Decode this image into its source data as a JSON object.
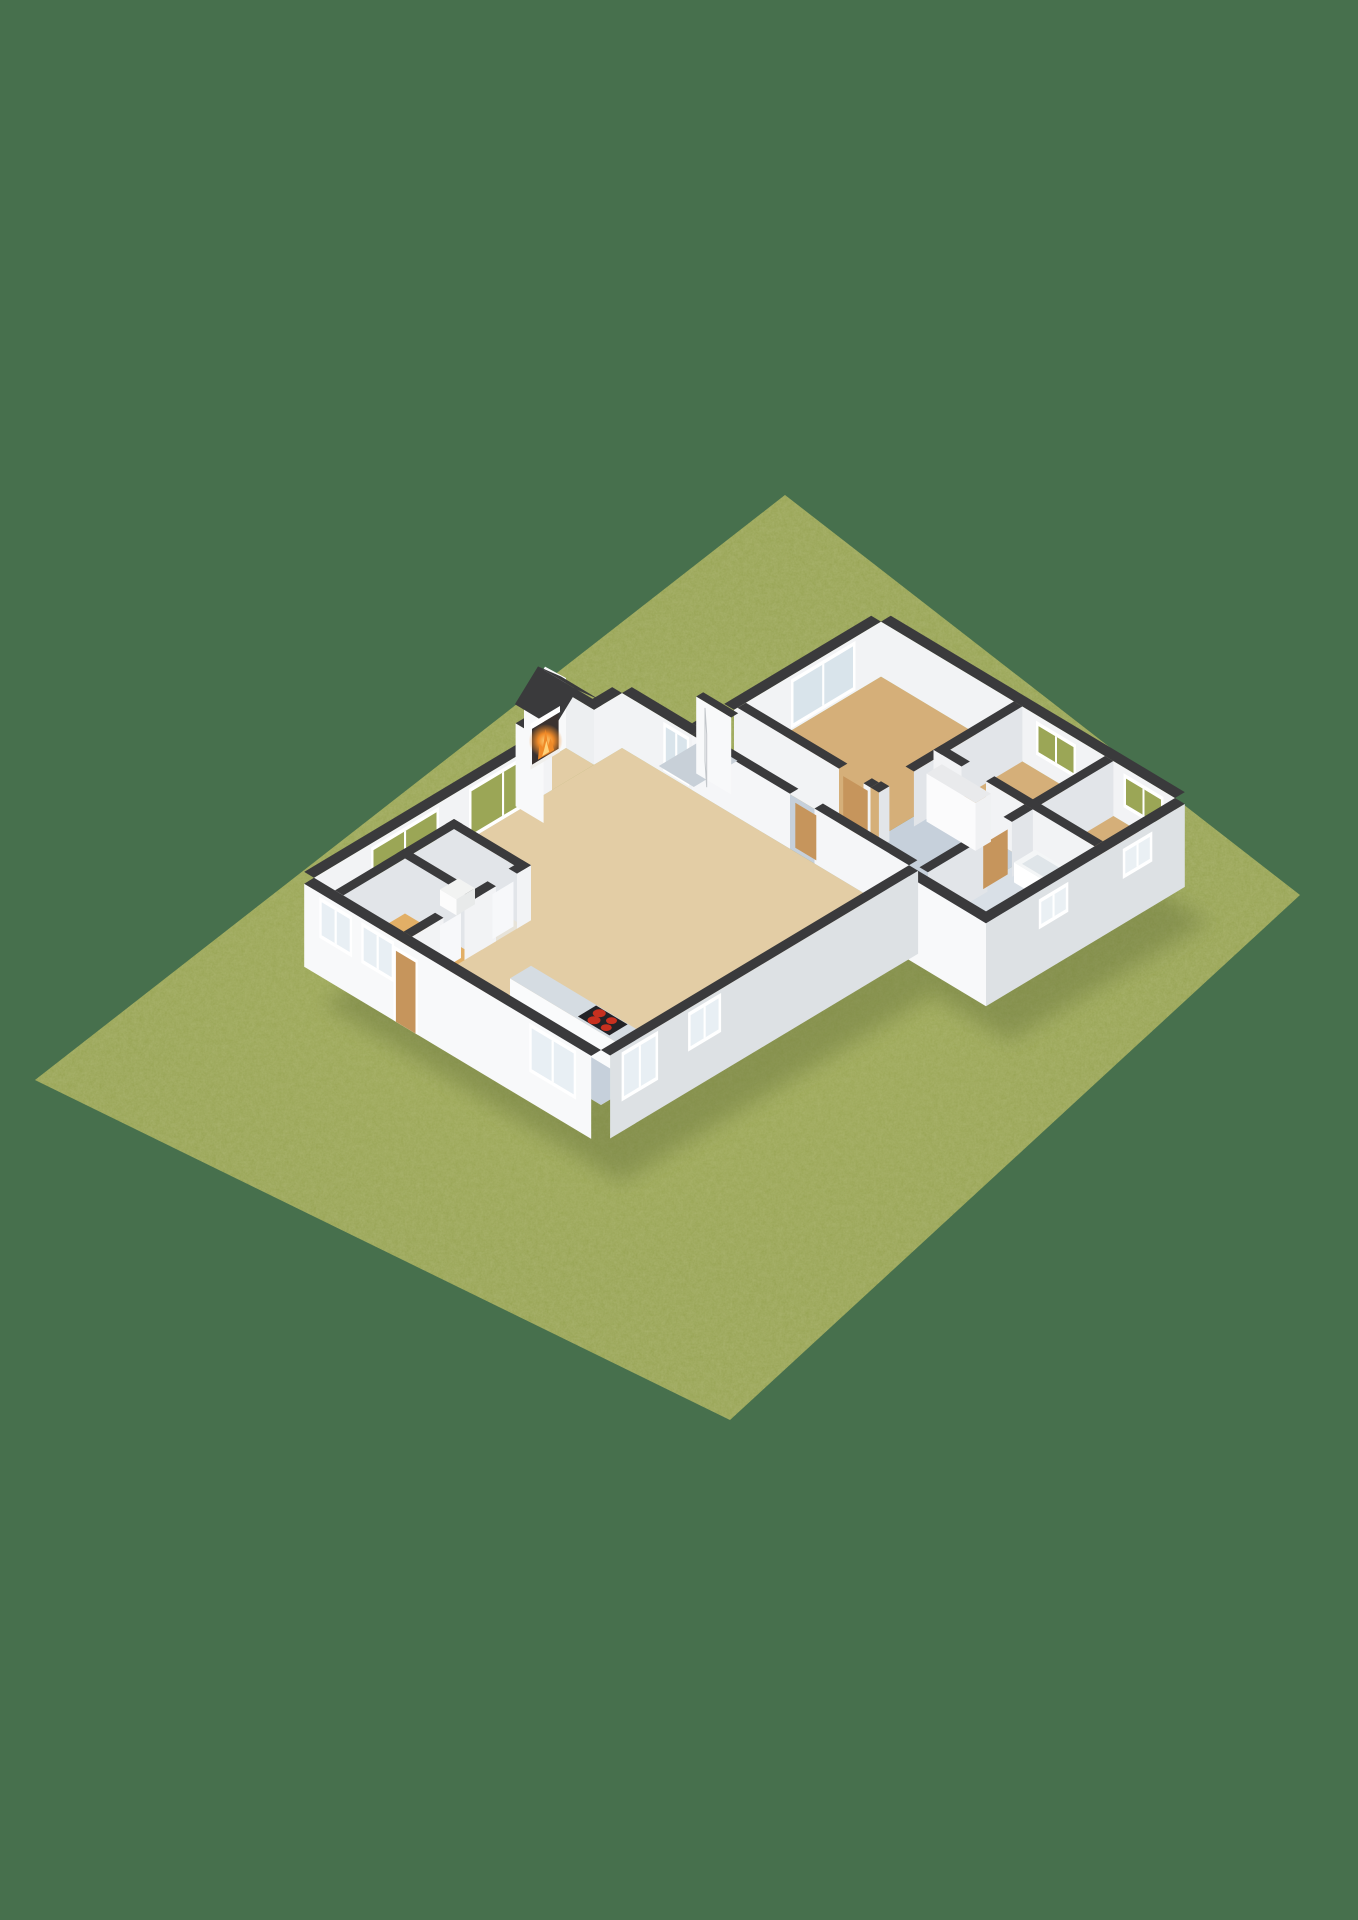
{
  "scene": {
    "title": "3D floor plan render",
    "style": "isometric cutaway dollhouse view of a single-story house on a grass plot",
    "background_color": "#47704D",
    "plot": {
      "type": "grass-lawn",
      "shape": "diamond",
      "buildings": 1
    },
    "colors": {
      "background": "#47704D",
      "grass": "#93A04E",
      "grassShadow": "#5E6B36",
      "grassThrough": "#9BA656",
      "wallCap": "#3A3A3C",
      "extWhite": "#F8F9FA",
      "extShade": "#DDE1E4",
      "intFace": "#F2F3F5",
      "intShade": "#E2E5E9",
      "floorLiving": "#E3CDA5",
      "floorWood": "#D5AF79",
      "floorBlue": "#C6D0DB",
      "floorBath": "#D9E0E7",
      "floorWC": "#E7E3D9",
      "floorUtility": "#E2AF66",
      "floorPorch": "#C8D0D8",
      "counterTop": "#D5DCE2",
      "counterFace": "#FAFBFC",
      "stove": "#232327",
      "burner": "#C8301F",
      "doorTan": "#C6955C",
      "glass": "#D9E4EB",
      "frame": "#FFFFFF",
      "darkOpen": "#3F4044",
      "hearthDark": "#3A3230",
      "fireCore": "#FFD27A",
      "fireMid": "#F08A28",
      "white": "#FFFFFF"
    },
    "rooms": [
      {
        "id": "living-room",
        "label": "Living room / dining",
        "floor": "floorLiving"
      },
      {
        "id": "fireplace-nook",
        "label": "Fireplace nook",
        "floor": "floorLiving"
      },
      {
        "id": "kitchen",
        "label": "Kitchen",
        "floor": "floorBlue"
      },
      {
        "id": "wc",
        "label": "Toilet room",
        "floor": "floorWC"
      },
      {
        "id": "utility-room",
        "label": "Utility room",
        "floor": "floorUtility"
      },
      {
        "id": "hallway",
        "label": "Hallway",
        "floor": "floorBlue"
      },
      {
        "id": "inner-hall",
        "label": "Inner hall",
        "floor": "floorBlue"
      },
      {
        "id": "master-bedroom",
        "label": "Master bedroom",
        "floor": "floorWood"
      },
      {
        "id": "bedroom-2",
        "label": "Bedroom 2",
        "floor": "floorWood"
      },
      {
        "id": "bedroom-3",
        "label": "Bedroom 3",
        "floor": "floorWood"
      },
      {
        "id": "bathroom",
        "label": "Bathroom",
        "floor": "floorBath"
      },
      {
        "id": "entry-porch",
        "label": "Entry porch",
        "floor": "floorPorch"
      }
    ],
    "objects": [
      {
        "id": "fireplace",
        "label": "Lit fireplace with white mantel",
        "state": "burning"
      },
      {
        "id": "cooktop",
        "label": "Black cooktop",
        "burners": 4
      },
      {
        "id": "toilet",
        "label": "Toilet"
      },
      {
        "id": "bathtub",
        "label": "Bathtub"
      },
      {
        "id": "vanity",
        "label": "Bathroom vanity"
      },
      {
        "id": "closet",
        "label": "Hall closet"
      },
      {
        "id": "front-door",
        "label": "Front door",
        "state": "open"
      }
    ],
    "windows": {
      "living_nw_double": 2,
      "front_sw": 3,
      "front_se": 2,
      "master_double": 1,
      "slit_high": 4,
      "entry_sidelight": 1
    }
  }
}
